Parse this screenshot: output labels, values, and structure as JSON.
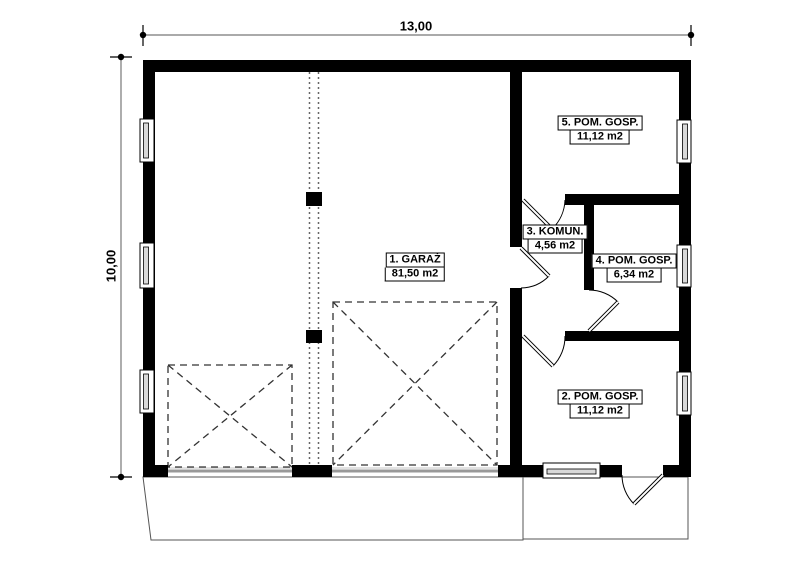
{
  "plan": {
    "type": "floor-plan",
    "dimensions": {
      "width_label": "13,00",
      "height_label": "10,00"
    },
    "rooms": [
      {
        "id": 1,
        "name": "1. GARAŻ",
        "area": "81,50 m2"
      },
      {
        "id": 2,
        "name": "2. POM. GOSP.",
        "area": "11,12 m2"
      },
      {
        "id": 3,
        "name": "3. KOMUN.",
        "area": "4,56 m2"
      },
      {
        "id": 4,
        "name": "4. POM. GOSP.",
        "area": "6,34 m2"
      },
      {
        "id": 5,
        "name": "5. POM. GOSP.",
        "area": "11,12 m2"
      }
    ],
    "colors": {
      "wall": "#000000",
      "background": "#ffffff",
      "dimension_line": "#777777",
      "garage_door_line": "#999999",
      "window_fill": "#d9d9d9"
    }
  }
}
